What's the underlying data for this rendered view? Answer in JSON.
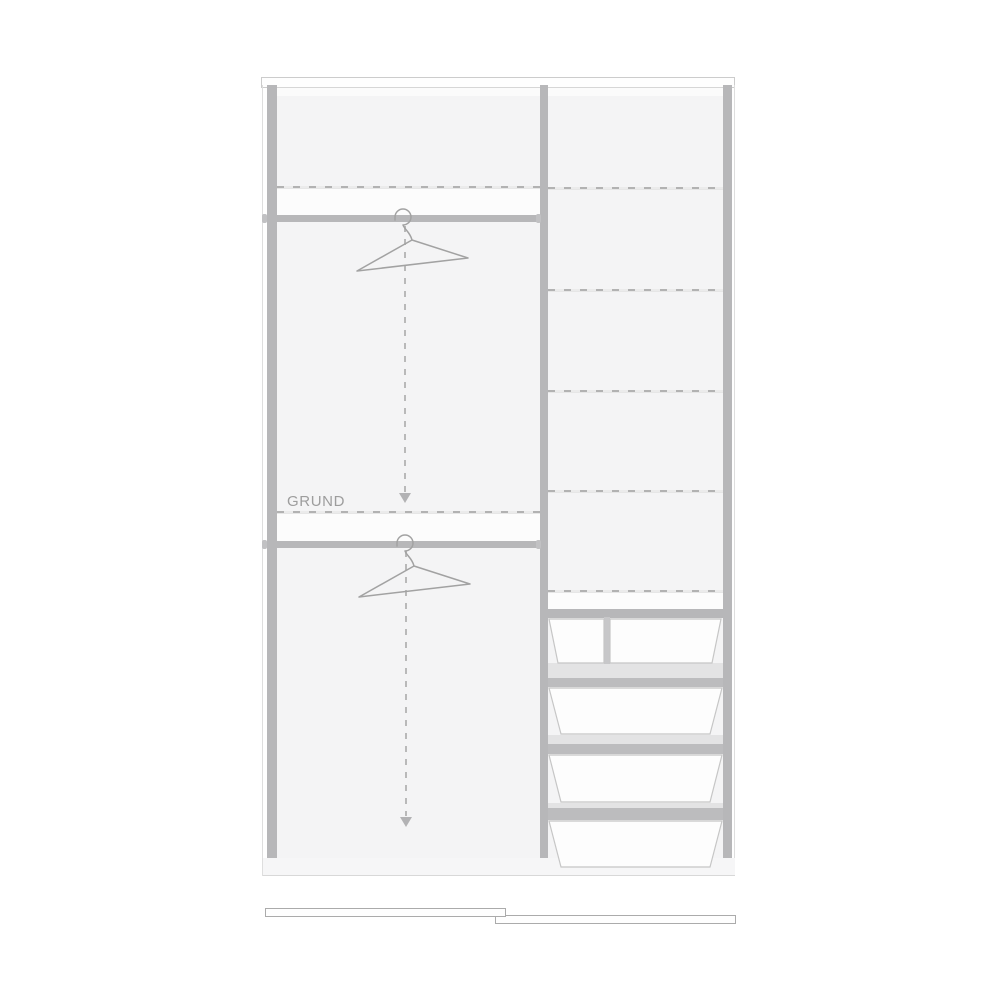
{
  "planner": {
    "label_grund": "GRUND",
    "colors": {
      "frame_gray": "#b7b7b9",
      "panel": "#f4f4f5",
      "shelf_band": "#fcfcfc",
      "dash_gray": "#b2b2b2",
      "rail_zone_light": "#e3e3e4",
      "rail_zone_dark": "#bcbcbe",
      "drawer_fill": "#fdfdfd",
      "drawer_stroke": "#c6c6c6",
      "door_stroke": "#ababab",
      "text_gray": "#9d9d9d"
    },
    "icons": {
      "hanger": "hanger-icon",
      "drag_arrow": "drag-down-arrow"
    },
    "left_section": {
      "clothes_rails": 2,
      "hangers": 2,
      "dashed_shelf_lines": 2
    },
    "right_section": {
      "dashed_shelf_lines": 5,
      "solid_shelves": 1,
      "drawers": 5
    },
    "doors": {
      "sliding_doors": 2
    }
  }
}
